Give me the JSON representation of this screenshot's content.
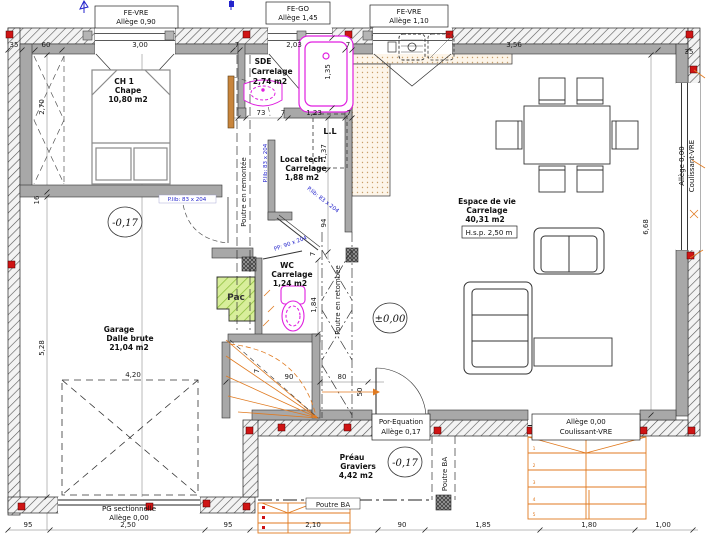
{
  "plan": {
    "windows": {
      "fe_vre_1": [
        "FE-VRE",
        "Allège 0,90"
      ],
      "fe_go": [
        "FE-GO",
        "Allège 1,45"
      ],
      "fe_vre_2": [
        "FE-VRE",
        "Allège 1,10"
      ],
      "coulissant_right": [
        "Allège 0,00",
        "Coulissant-VRE"
      ],
      "por_equation": [
        "Por-Equation",
        "Allège 0,17"
      ],
      "coulissant_bottom": [
        "Allège 0,00",
        "Coulissant-VRE"
      ],
      "pg_sectionnelle": [
        "PG sectionnelle",
        "Allège 0,00"
      ]
    },
    "rooms": {
      "ch1": [
        "CH 1",
        "Chape",
        "10,80 m2"
      ],
      "sde": [
        "SDE",
        "Carrelage",
        "2,74 m2"
      ],
      "local_tech": [
        "Local tech.",
        "Carrelage",
        "1,88 m2"
      ],
      "living": [
        "Espace de vie",
        "Carrelage",
        "40,31 m2"
      ],
      "living_hsp": "H.s.p. 2,50 m",
      "wc": [
        "WC",
        "Carrelage",
        "1,24 m2"
      ],
      "garage": [
        "Garage",
        "Dalle brute",
        "21,04 m2"
      ],
      "preau": [
        "Préau",
        "Graviers",
        "4,42 m2"
      ]
    },
    "levels": {
      "garage": "-0,17",
      "living": "±0,00",
      "preau": "-0,17"
    },
    "beams": {
      "remontee": "Poutre en remontée",
      "retombee": "Poutre en retombée",
      "ba_vertical": "Poutre BA",
      "ba_horizontal": "Poutre BA"
    },
    "equipment": {
      "pac": "Pac",
      "washer": "L.L"
    },
    "door_notes": {
      "d1": "P.lib: 83 x 204",
      "d2": "P.lib: 83 x 204",
      "d3": "P.lib: 83 x 204",
      "d4": "PP: 90 x 204"
    },
    "dims": {
      "top": [
        "35",
        "60",
        "3,00",
        "7",
        "2,03",
        "7",
        "3,56",
        "35"
      ],
      "sde": [
        "73",
        "7",
        "1,23",
        "7"
      ],
      "mid": {
        "bath_h": "1,35",
        "ll_h": "1,37",
        "hall": "94",
        "wall": "7",
        "entry": "1,84",
        "stair_w": "90",
        "corridor": "80",
        "stair_d": "50",
        "s7": "7"
      },
      "left": {
        "closet": "2,70",
        "wall": "16",
        "garage_h": "5,28"
      },
      "right": {
        "living_h": "6,68"
      },
      "garage_door": "4,20",
      "bottom": [
        "95",
        "2,50",
        "95",
        "2,10",
        "90",
        "1,85",
        "1,80",
        "1,00"
      ]
    },
    "steps_right": [
      "1",
      "2",
      "3",
      "4",
      "5"
    ],
    "colors": {
      "sanitary": "#e01fe0",
      "stairs": "#e07a20",
      "pac_green": "#8fbf3f",
      "note_blue": "#2323cc",
      "post_red": "#cf1414",
      "wall_gray": "#a8a8a8"
    }
  }
}
